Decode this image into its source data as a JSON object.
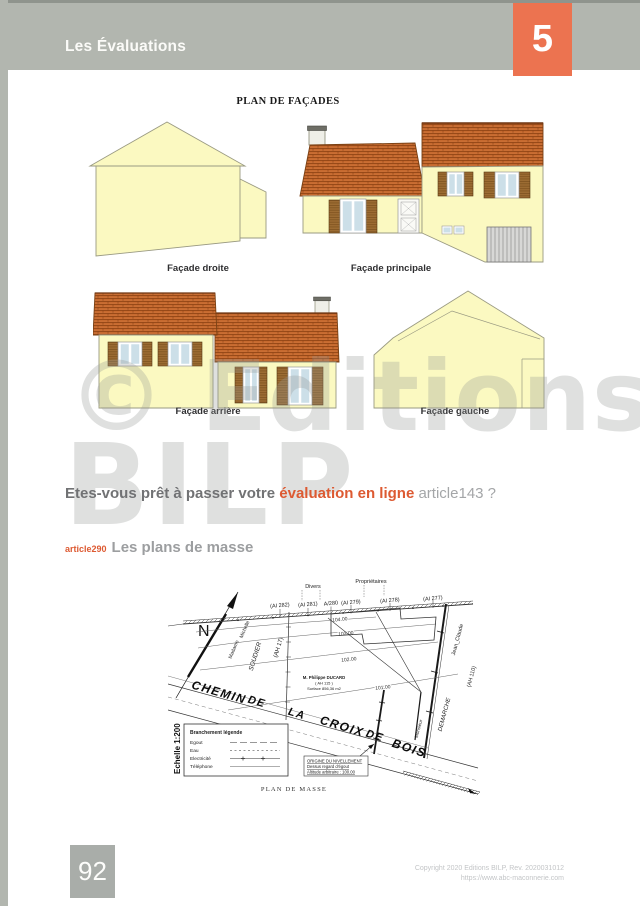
{
  "header": {
    "title": "Les Évaluations",
    "chapter": "5"
  },
  "facades": {
    "plan_title": "PLAN DE FAÇADES",
    "labels": [
      "Façade droite",
      "Façade principale",
      "Façade arrière",
      "Façade gauche"
    ]
  },
  "watermark": {
    "line1": "© Editions",
    "line2": "BILP"
  },
  "question": {
    "prefix": "Etes-vous prêt à passer votre ",
    "highlight": "évaluation en ligne",
    "suffix": " article143 ?"
  },
  "section": {
    "ref": "article290",
    "title": "Les plans de masse"
  },
  "site_plan": {
    "caption": "PLAN DE MASSE",
    "scale_label": "Echelle 1:200",
    "north_letter": "N",
    "road_name_words": [
      "CHEMIN",
      "DE",
      "LA",
      "CROIX",
      "DE",
      "BOIS"
    ],
    "top_row_labels": [
      "Divers",
      "Propriétaires"
    ],
    "parcel_labels": [
      "(AI 282)",
      "(AI 281)",
      "A/280",
      "(AI 279)",
      "(AI 278)",
      "(AI 277)"
    ],
    "contour_labels": [
      "104.00",
      "103.00",
      "102.00",
      "101.00"
    ],
    "neighbor_left": {
      "line1": "Madame",
      "line2": "Michelle",
      "line3": "SOUDIER",
      "line4": "(AH 17)"
    },
    "neighbor_right": {
      "line1": "Monsieur",
      "line2": "Jean_Claude",
      "line3": "DEMARCHE",
      "line4": "(AH 110)"
    },
    "owner": {
      "line1": "M. Philippe DUCARD",
      "line2": "( AH 115 )",
      "line3": "Surface 856,36 m2"
    },
    "legend": {
      "title": "Branchement légende",
      "items": [
        "Egout",
        "Eau",
        "Electricité",
        "Téléphone"
      ]
    },
    "levelling": {
      "line1": "ORIGINE DU NIVELLEMENT",
      "line2": "Dessus regard d'égout",
      "line3": "Altitude arbitraire : 100.00"
    }
  },
  "footer": {
    "page_number": "92",
    "copyright_line1": "Copyright 2020 Editions BILP, Rev. 2020031012",
    "copyright_line2": "https://www.abc-maconnerie.com"
  },
  "colors": {
    "header_gray": "#b2b6af",
    "accent_orange": "#ec7350",
    "text_orange": "#dd5a32",
    "house_yellow": "#fbf9c1",
    "roof_brown": "#c4652a"
  }
}
